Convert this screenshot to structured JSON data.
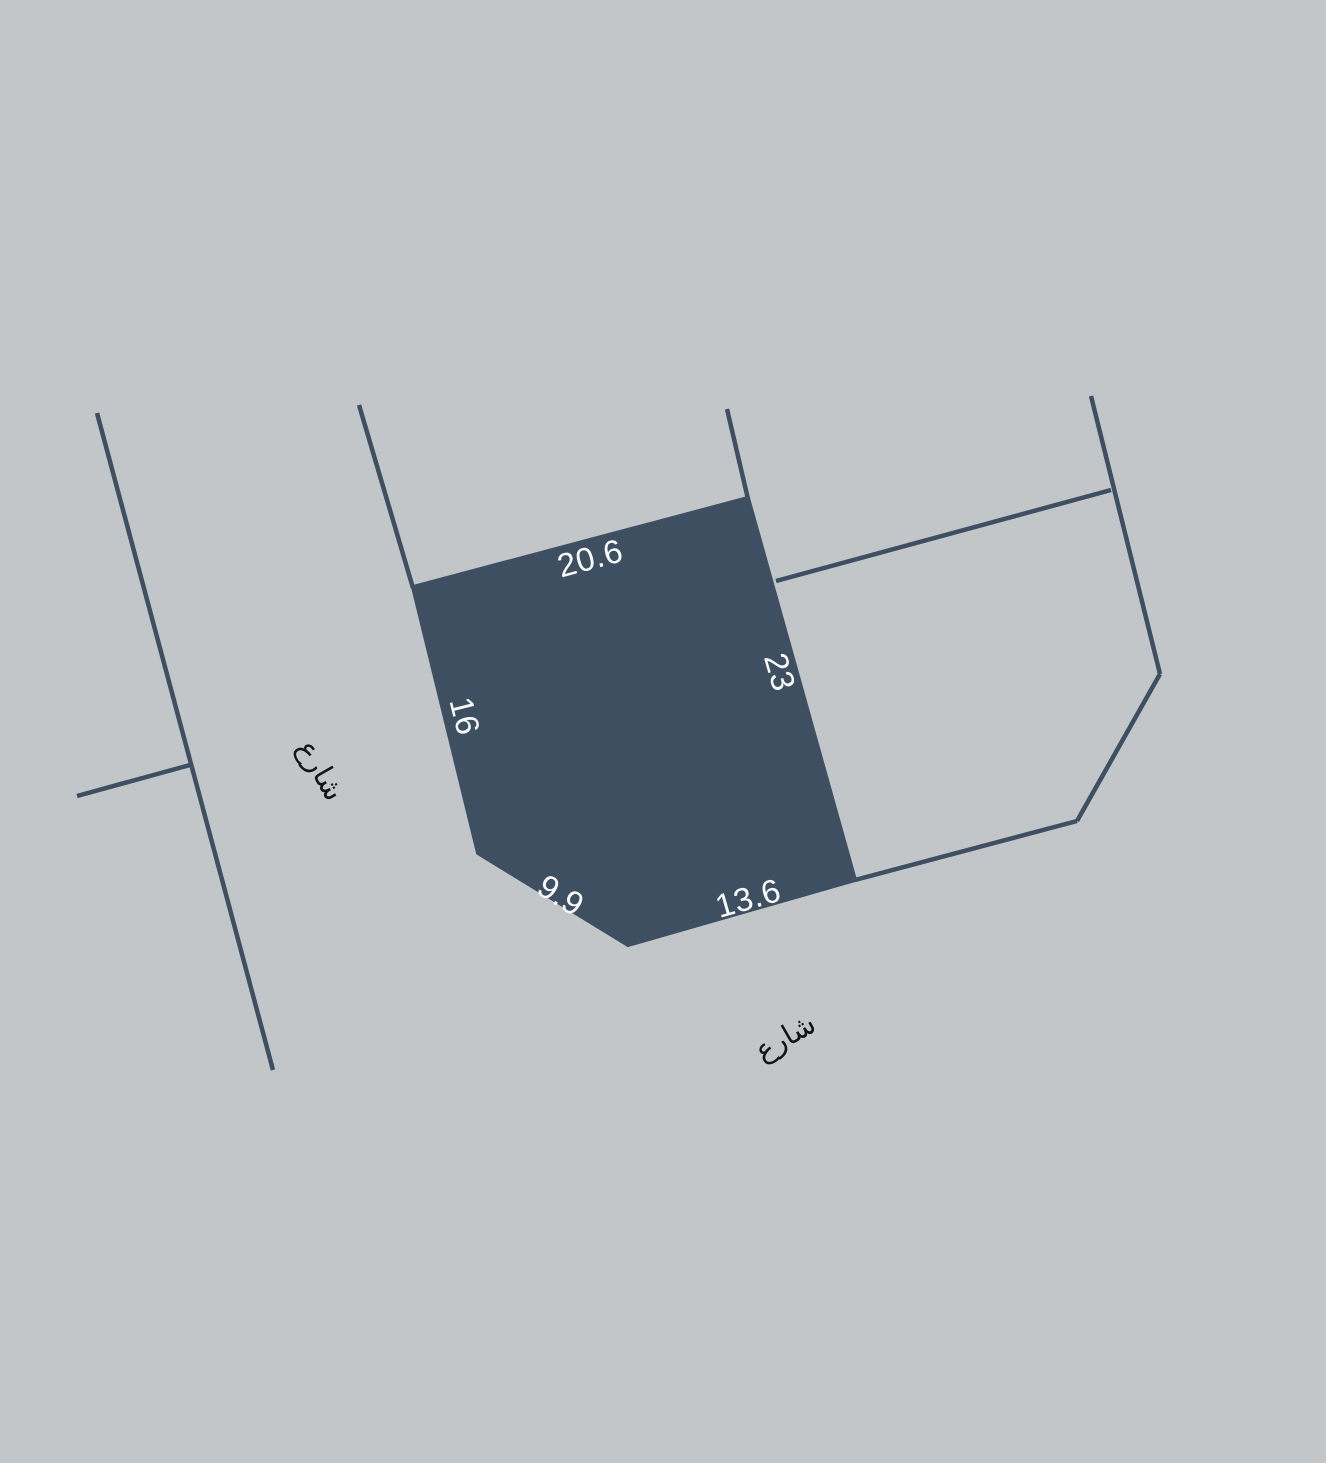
{
  "canvas": {
    "width": 1326,
    "height": 1463,
    "background": "#c2c6c9"
  },
  "palette": {
    "parcel_fill": "#3e4f62",
    "boundary_line": "#3e4f62",
    "dimension_label_color": "#f9fafa",
    "street_label_color": "#141414"
  },
  "parcel": {
    "name": "selected-parcel",
    "points": [
      [
        413,
        587
      ],
      [
        748,
        498
      ],
      [
        855,
        880
      ],
      [
        628,
        945
      ],
      [
        478,
        853
      ]
    ],
    "dimension_labels": [
      {
        "name": "dim-top-edge",
        "text": "20.6",
        "x": 590,
        "y": 558,
        "rotation": -15
      },
      {
        "name": "dim-right-edge",
        "text": "23",
        "x": 780,
        "y": 672,
        "rotation": 74
      },
      {
        "name": "dim-left-edge",
        "text": "16",
        "x": 465,
        "y": 716,
        "rotation": 76
      },
      {
        "name": "dim-bottom-left-edge",
        "text": "9.9",
        "x": 561,
        "y": 895,
        "rotation": 32
      },
      {
        "name": "dim-bottom-edge",
        "text": "13.6",
        "x": 748,
        "y": 898,
        "rotation": -16
      }
    ]
  },
  "street_labels": [
    {
      "name": "street-label-west",
      "text": "شارع",
      "x": 321,
      "y": 770,
      "rotation": 60
    },
    {
      "name": "street-label-south",
      "text": "شارع",
      "x": 785,
      "y": 1037,
      "rotation": -30
    }
  ],
  "boundary_lines": [
    {
      "name": "west-street-line",
      "x1": 97,
      "y1": 413,
      "x2": 273,
      "y2": 1070
    },
    {
      "name": "west-street-branch-line",
      "x1": 190,
      "y1": 765,
      "x2": 77,
      "y2": 796
    },
    {
      "name": "upper-left-boundary-line",
      "x1": 359,
      "y1": 405,
      "x2": 413,
      "y2": 588
    },
    {
      "name": "upper-right-boundary-line",
      "x1": 727,
      "y1": 409,
      "x2": 748,
      "y2": 499
    },
    {
      "name": "east-parcel-divider-line",
      "x1": 776,
      "y1": 581,
      "x2": 1111,
      "y2": 490
    },
    {
      "name": "east-parcel-right-boundary",
      "x1": 1091,
      "y1": 396,
      "x2": 1160,
      "y2": 674
    },
    {
      "name": "east-parcel-corner-boundary",
      "x1": 1160,
      "y1": 674,
      "x2": 1077,
      "y2": 821
    },
    {
      "name": "east-parcel-bottom-boundary",
      "x1": 1077,
      "y1": 821,
      "x2": 855,
      "y2": 880
    }
  ]
}
